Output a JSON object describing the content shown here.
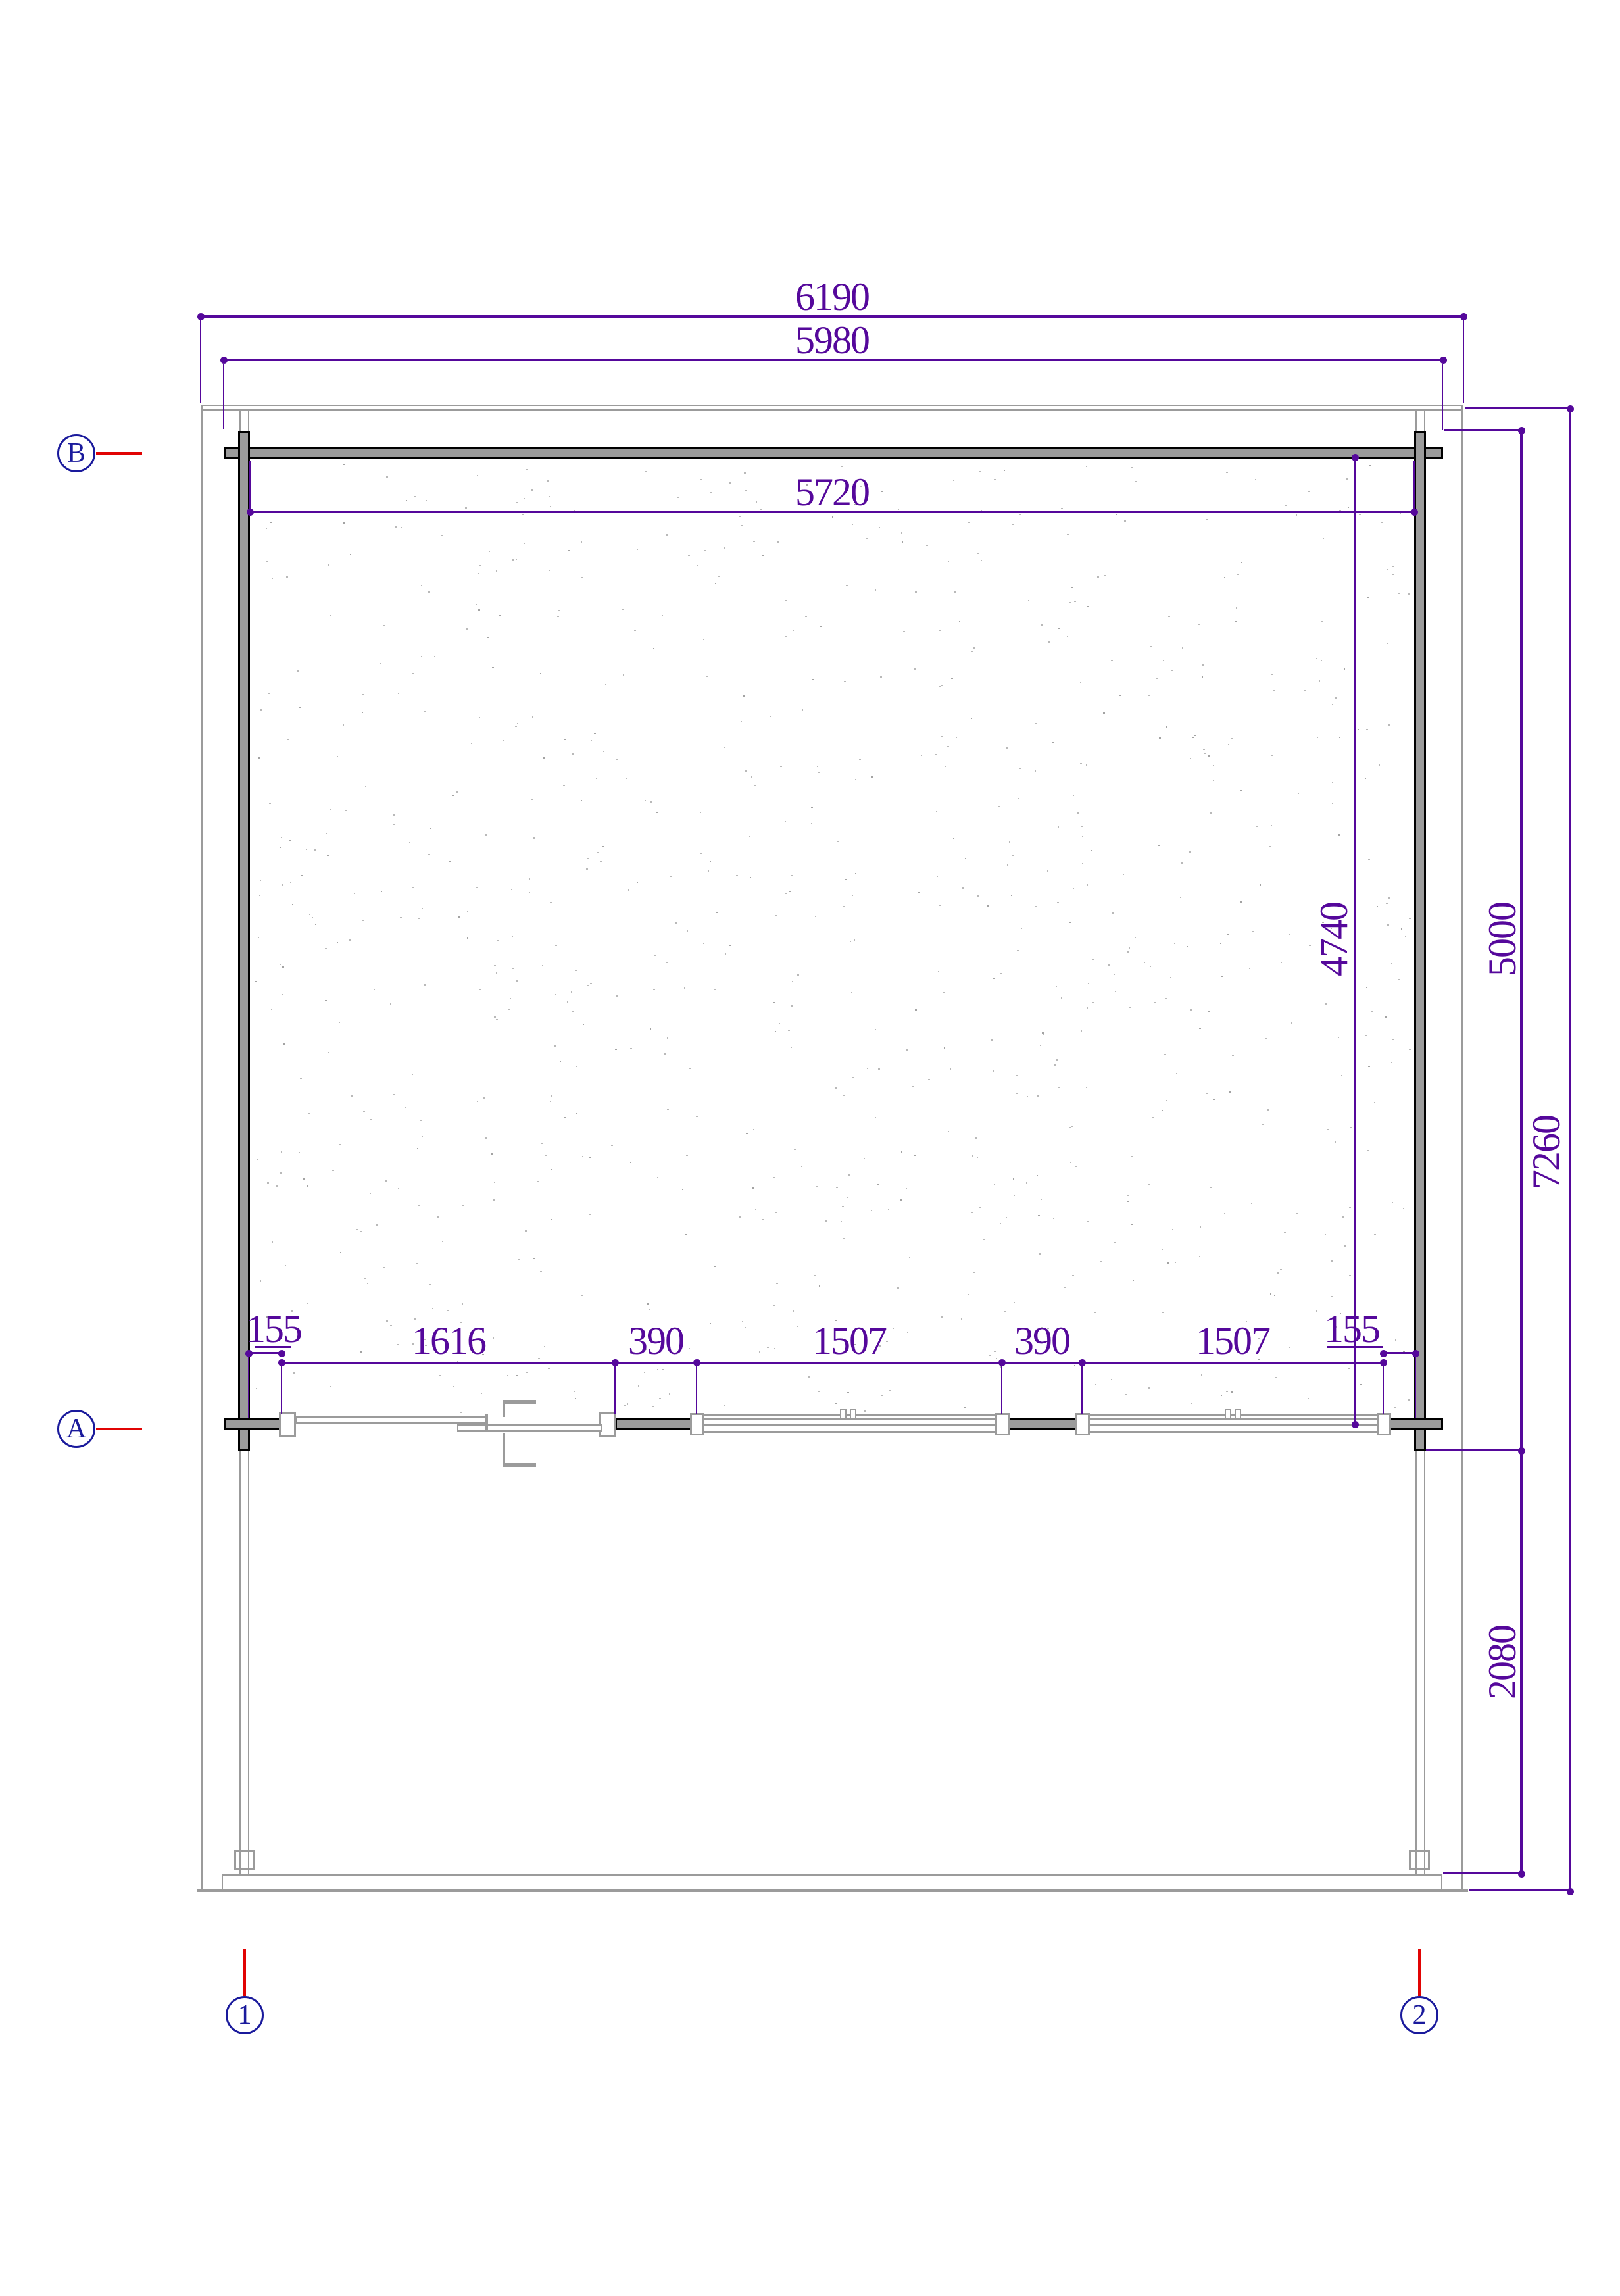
{
  "drawing": {
    "type": "floor-plan",
    "colors": {
      "dimension": "#55089b",
      "grid_marker": "#1a1a9c",
      "leader_line": "#e10404",
      "wall_fill": "#9b9b9b",
      "wall_edge": "#000000",
      "speckle": "#b5b5b5"
    },
    "dimensions": {
      "top": [
        {
          "name": "overall-width",
          "label": "6190"
        },
        {
          "name": "wall-outer-width",
          "label": "5980"
        },
        {
          "name": "interior-width",
          "label": "5720"
        }
      ],
      "right": [
        {
          "name": "interior-depth",
          "label": "4740"
        },
        {
          "name": "cabin-depth",
          "label": "5000"
        },
        {
          "name": "overall-depth",
          "label": "7260"
        },
        {
          "name": "terrace-depth",
          "label": "2080"
        }
      ],
      "front": [
        {
          "name": "offset-left",
          "label": "155"
        },
        {
          "name": "door-opening",
          "label": "1616"
        },
        {
          "name": "pier-left",
          "label": "390"
        },
        {
          "name": "window-left",
          "label": "1507"
        },
        {
          "name": "pier-right",
          "label": "390"
        },
        {
          "name": "window-right",
          "label": "1507"
        },
        {
          "name": "offset-right",
          "label": "155"
        }
      ]
    },
    "grid_markers": {
      "row_top": "B",
      "row_bottom": "A",
      "col_left": "1",
      "col_right": "2"
    }
  }
}
